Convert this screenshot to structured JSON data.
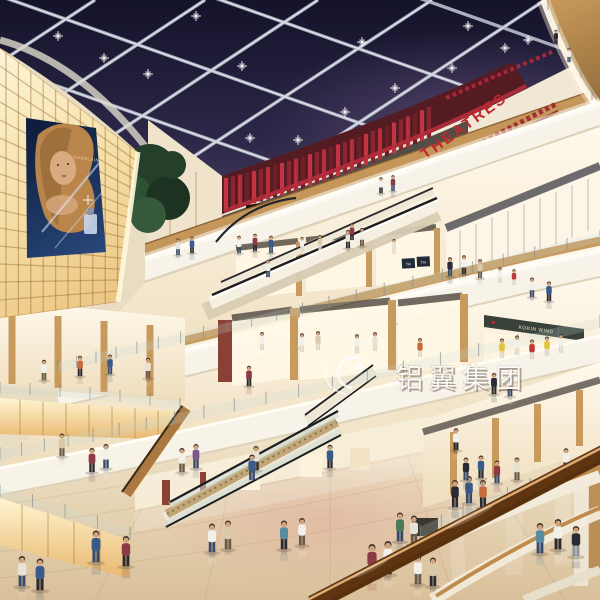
{
  "meta": {
    "description": "Photorealistic rendering of a multi-level shopping mall atrium at night",
    "setting": "shopping-mall-interior"
  },
  "signs": {
    "theatres": "THEATRES",
    "tai_tai_panels": [
      "TAI",
      "TAI"
    ],
    "boutique": "KOKIN WING"
  },
  "billboard": {
    "brand": "GUERLAIN"
  },
  "watermark": {
    "text": "铝翼集团"
  },
  "colors": {
    "sky_top": "#15142a",
    "sky_bottom": "#4c4066",
    "beam": "#c3c9d6",
    "theatre_red": "#c0272f",
    "slat_red": "#c23442",
    "glow_warm": "#f8e9c0",
    "glow_deep": "#e9bf78",
    "wood": "#c0914f",
    "wood_dark": "#8a5f2e",
    "fascia": "#f7f1e3",
    "fascia_shadow": "#d6c9ab",
    "floor_light": "#efe1c4",
    "floor_dark": "#dcc49e",
    "floor_pink": "#e0b4a4",
    "screen_fire": "#ff8c2a",
    "billboard_navy": "#13244a",
    "rail_wood": "#a05c1e",
    "store_warm": "#fdf4e0"
  }
}
